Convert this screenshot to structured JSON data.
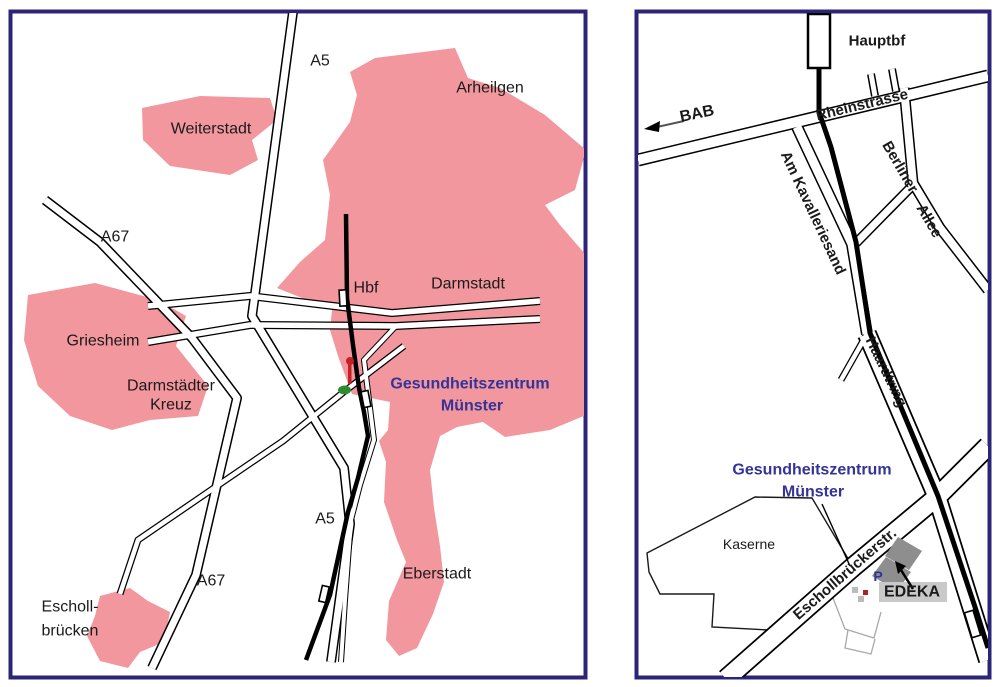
{
  "left_map": {
    "a5_north": "A5",
    "a5_south": "A5",
    "a67_north": "A67",
    "a67_south": "A67",
    "weiterstadt": "Weiterstadt",
    "arheilgen": "Arheilgen",
    "darmstadt": "Darmstadt",
    "griesheim": "Griesheim",
    "darmstaedter_kreuz_line1": "Darmstädter",
    "darmstaedter_kreuz_line2": "Kreuz",
    "hbf": "Hbf",
    "destination_line1": "Gesundheitszentrum",
    "destination_line2": "Münster",
    "eberstadt": "Eberstadt",
    "eschollbruecken_line1": "Escholl-",
    "eschollbruecken_line2": "brücken"
  },
  "right_map": {
    "hauptbf": "Hauptbf",
    "bab": "BAB",
    "rheinstrasse": "Rheinstrasse",
    "am_kavalleriesand": "Am Kavalleriesand",
    "berliner": "Berliner",
    "allee": "Allee",
    "haardtring": "Haardtring",
    "destination_line1": "Gesundheitszentrum",
    "destination_line2": "Münster",
    "kaserne": "Kaserne",
    "eschollbrueckerstr": "Eschollbrückerstr.",
    "parking": "P",
    "edeka": "EDEKA"
  },
  "colors": {
    "area_fill": "#F2979D",
    "destination_text": "#333399",
    "map_border": "#2B2478",
    "marker_red": "#C22222",
    "marker_green": "#2E8B2E",
    "building_gray": "#8E8E8E"
  }
}
